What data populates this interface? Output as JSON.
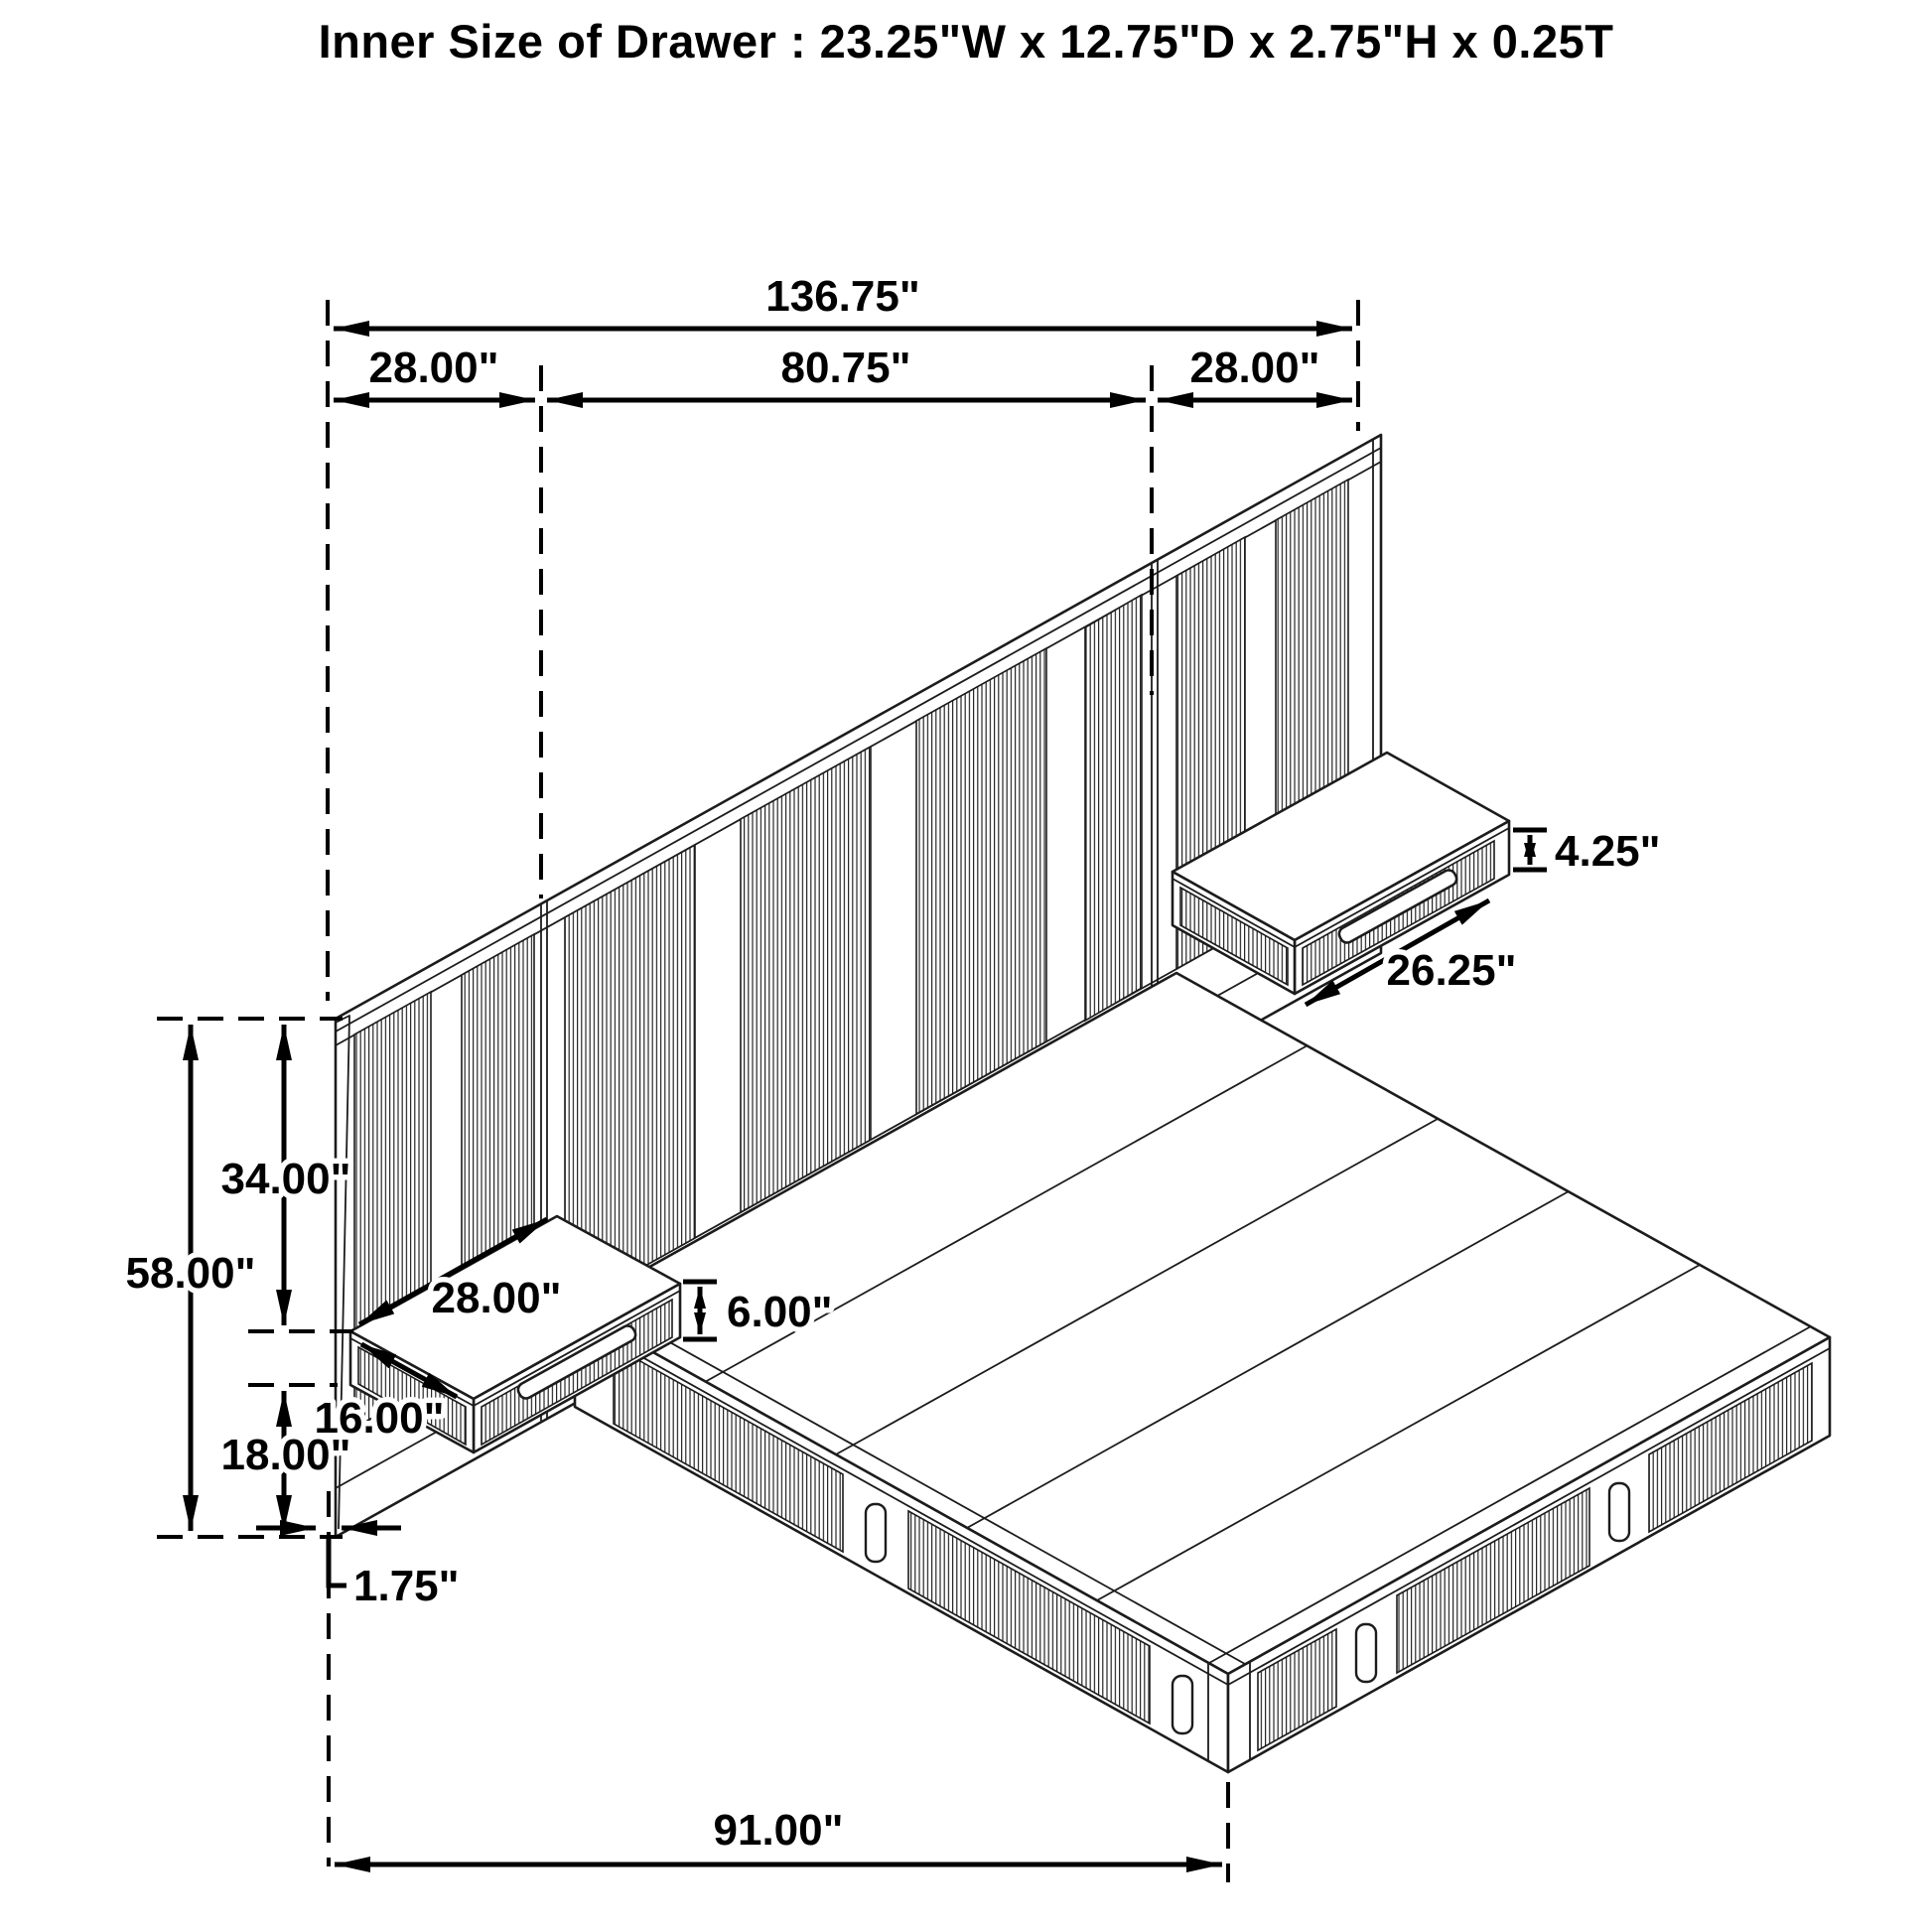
{
  "title": "Inner Size of Drawer : 23.25\"W x 12.75\"D x 2.75\"H x 0.25T",
  "dimensions": {
    "top": {
      "overall_width": "136.75\"",
      "left_wing": "28.00\"",
      "center_section": "80.75\"",
      "right_wing": "28.00\""
    },
    "left": {
      "total_height": "58.00\"",
      "upper_height": "34.00\"",
      "lower_height": "18.00\""
    },
    "nightstand": {
      "width": "28.00\"",
      "depth": "16.00\"",
      "height": "6.00\""
    },
    "drawer": {
      "front_height": "4.25\"",
      "front_width": "26.25\""
    },
    "base": {
      "leg_offset": "1.75\"",
      "bed_length": "91.00\""
    }
  }
}
